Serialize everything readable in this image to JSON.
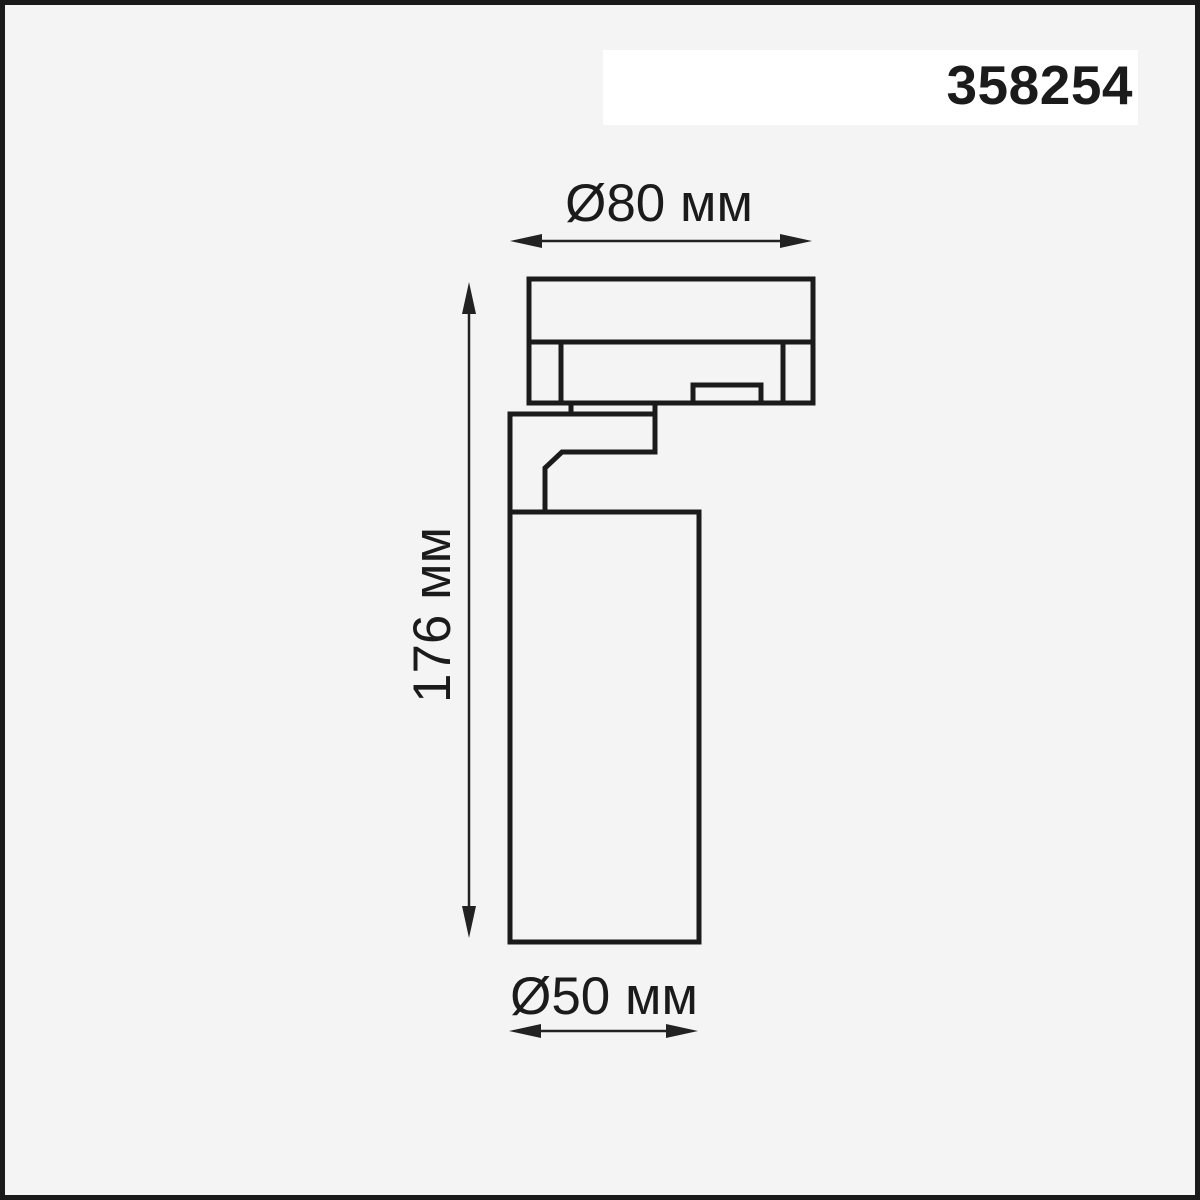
{
  "page": {
    "background_color": "#f4f4f5",
    "frame_color": "#191919"
  },
  "header": {
    "article_number": "358254",
    "band_color": "#ffffff"
  },
  "diagram": {
    "line_color": "#1b1b1b",
    "labels": {
      "top_width": "Ø80 мм",
      "height": "176 мм",
      "bottom_width": "Ø50 мм"
    }
  }
}
